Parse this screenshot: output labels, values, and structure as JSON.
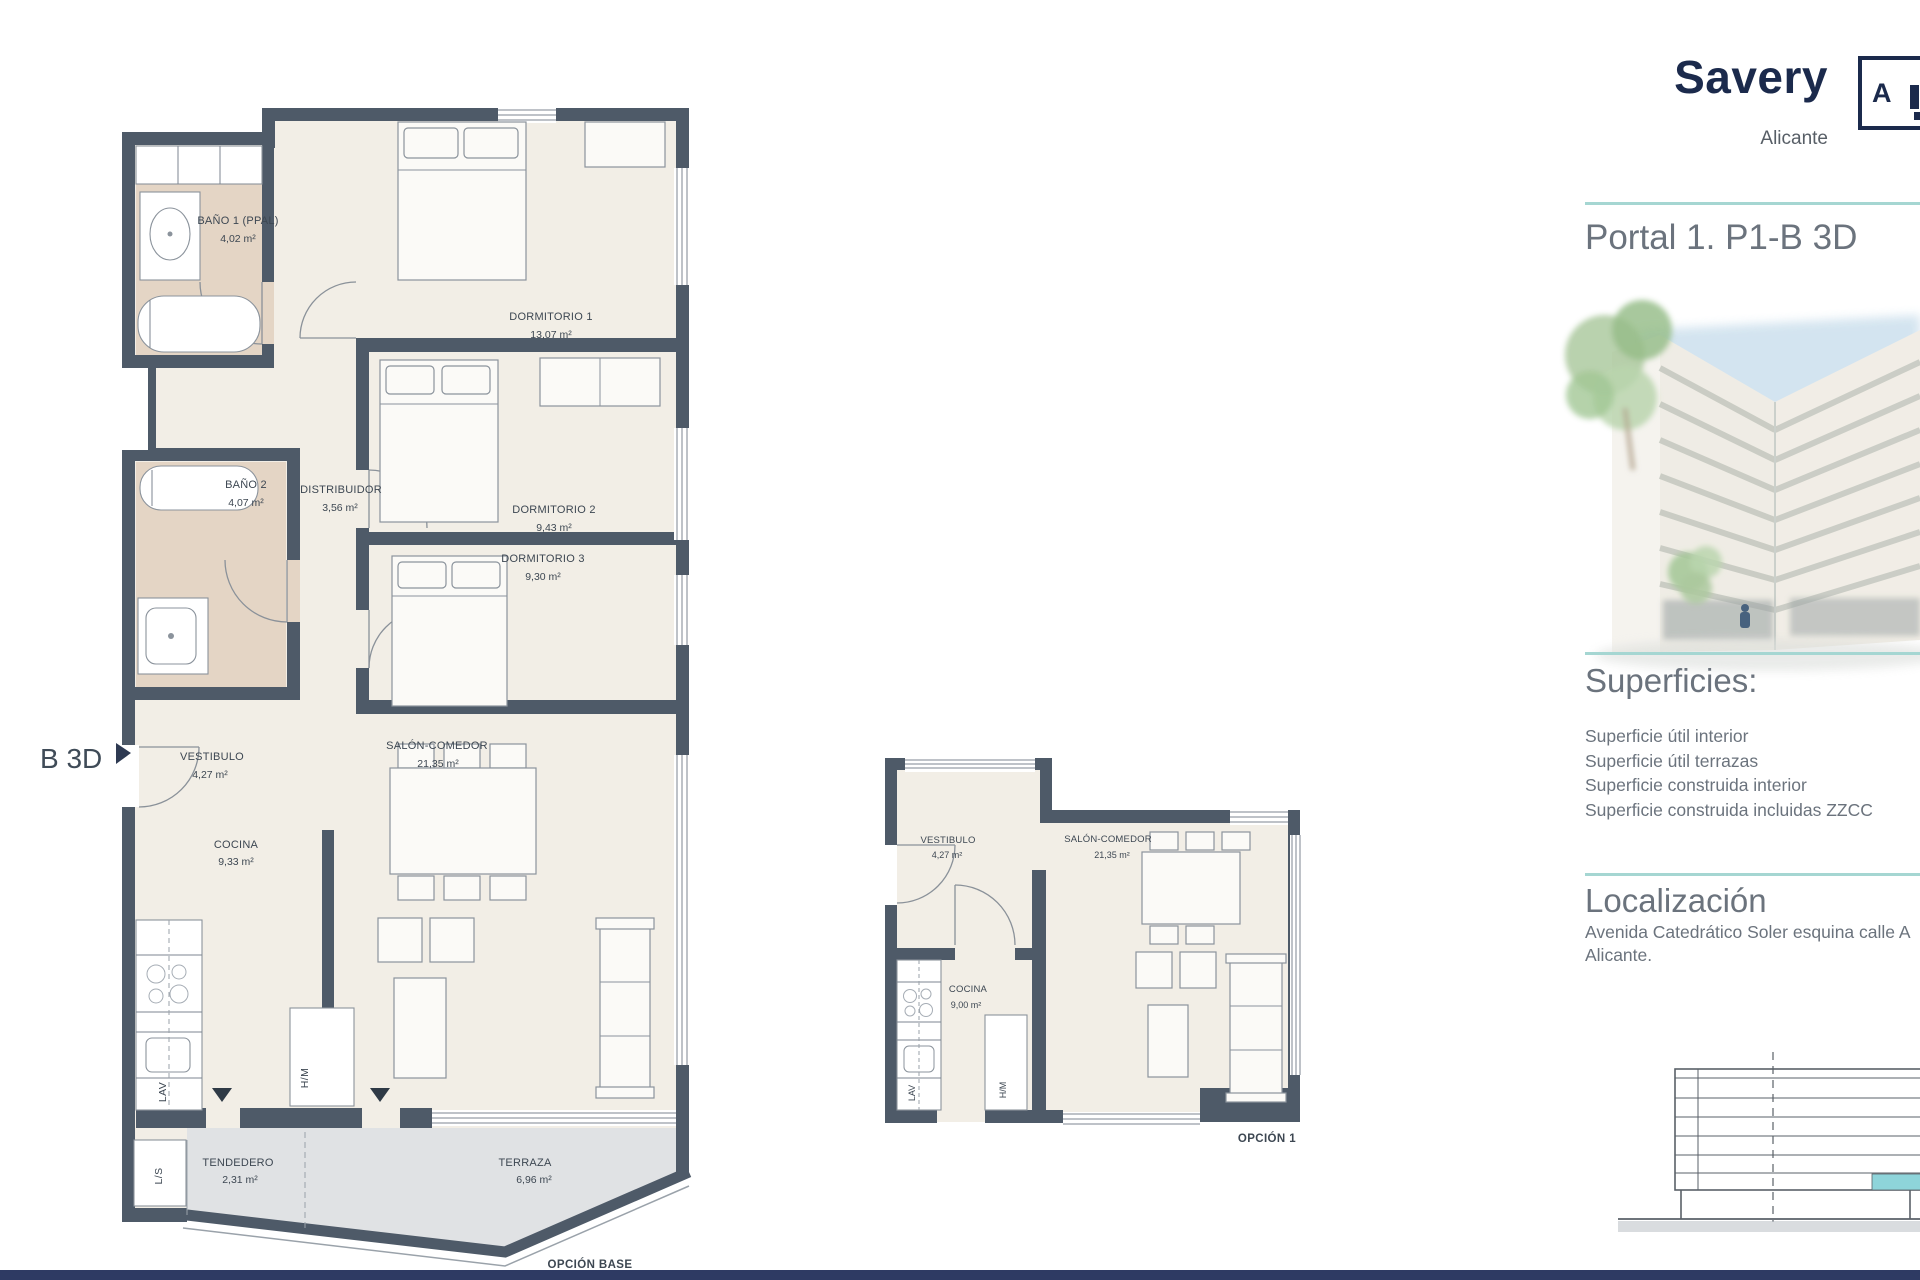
{
  "header": {
    "brand": "Savery",
    "city": "Alicante",
    "logo_text": "A",
    "title": "Portal 1. P1-B 3D"
  },
  "sections": {
    "superficies": {
      "heading": "Superficies:",
      "items": [
        "Superficie útil interior",
        "Superficie útil terrazas",
        "Superficie construida interior",
        "Superficie construida incluidas ZZCC"
      ]
    },
    "localizacion": {
      "heading": "Localización",
      "address": "Avenida Catedrático Soler esquina calle A",
      "city": "Alicante."
    }
  },
  "plans": {
    "base": {
      "caption": "OPCIÓN BASE",
      "side_label": "B 3D",
      "rooms": {
        "bano1": {
          "name": "BAÑO 1 (PPAL)",
          "area": "4,02 m²"
        },
        "dormitorio1": {
          "name": "DORMITORIO 1",
          "area": "13,07 m²"
        },
        "bano2": {
          "name": "BAÑO 2",
          "area": "4,07 m²"
        },
        "distribuidor": {
          "name": "DISTRIBUIDOR",
          "area": "3,56 m²"
        },
        "dormitorio2": {
          "name": "DORMITORIO 2",
          "area": "9,43 m²"
        },
        "dormitorio3": {
          "name": "DORMITORIO 3",
          "area": "9,30 m²"
        },
        "vestibulo": {
          "name": "VESTIBULO",
          "area": "4,27 m²"
        },
        "salon": {
          "name": "SALÓN-COMEDOR",
          "area": "21,35 m²"
        },
        "cocina": {
          "name": "COCINA",
          "area": "9,33 m²"
        },
        "tendedero": {
          "name": "TENDEDERO",
          "area": "2,31 m²"
        },
        "terraza": {
          "name": "TERRAZA",
          "area": "6,96 m²"
        }
      },
      "fixtures": {
        "lav": "LAV",
        "hm": "H/M",
        "ls": "L/S"
      }
    },
    "opcion1": {
      "caption": "OPCIÓN 1",
      "rooms": {
        "vestibulo": {
          "name": "VESTIBULO",
          "area": "4,27 m²"
        },
        "salon": {
          "name": "SALÓN-COMEDOR",
          "area": "21,35 m²"
        },
        "cocina": {
          "name": "COCINA",
          "area": "9,00 m²"
        }
      },
      "fixtures": {
        "lav": "LAV",
        "hm": "H/M"
      }
    }
  },
  "colors": {
    "brand_navy": "#1b2a4c",
    "teal_divider": "#a5d6d2",
    "wall": "#4e5a68",
    "bath_floor": "#e4d5c5",
    "terrace_floor": "#e0e2e4",
    "unit_highlight": "#8ed4da",
    "footer_bar": "#2e3a63"
  }
}
